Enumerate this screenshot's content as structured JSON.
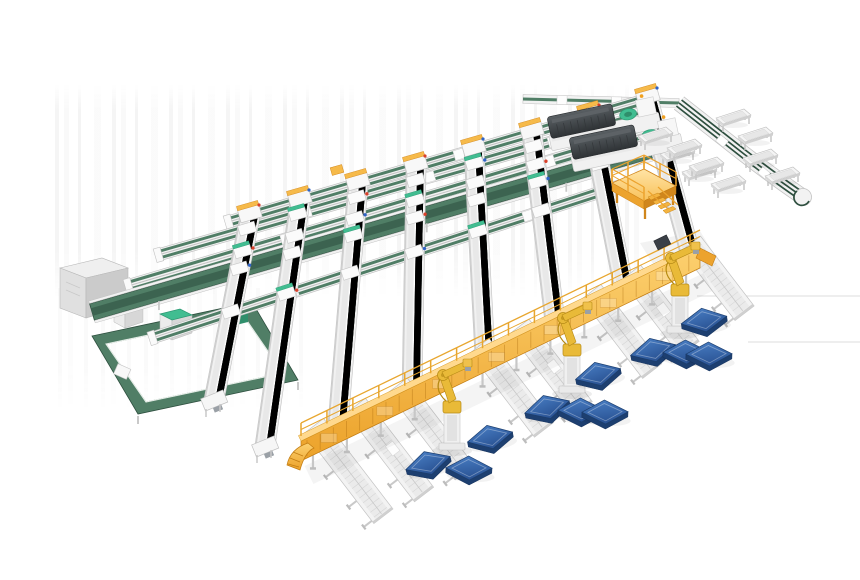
{
  "meta": {
    "description": "isometric 3d render of an automated parcel sorting and palletizing warehouse system",
    "background": "#ffffff",
    "canvas": {
      "w": 860,
      "h": 580
    }
  },
  "names": {
    "scene": "warehouse-3d-scene",
    "grid_line": "conveyor-line",
    "sorting_lane": "sorting-lane",
    "crossing_module": "transfer-module",
    "loop": "loop-conveyor",
    "cabinet": "control-cabinet",
    "small_machine": "scanner-machine",
    "dark_machine": "printer-sorter-machine",
    "platform": "operator-platform",
    "stairs": "platform-stairs",
    "outfeed": "outfeed-conveyor",
    "stand": "tray-stand",
    "walkway": "elevated-walkway-conveyor",
    "ramp": "walkway-ramp",
    "railing": "walkway-railing",
    "out_lane": "roller-lane",
    "robot": "palletizing-robot",
    "pallet": "pallet",
    "shadow": "floor-shadow",
    "floor_line": "floor-guide-line",
    "accent": "accent-marker"
  },
  "colors": {
    "frame": "#f2f2f2",
    "frame_mid": "#e4e4e4",
    "frame_dark": "#c2c2c2",
    "frame_edge": "#aeaeae",
    "belt": "#507e66",
    "belt_dark": "#3c6350",
    "belt_deep": "#2e4f3f",
    "teal": "#41bd91",
    "teal_dark": "#2d9a74",
    "teal_side": "#2f8e6b",
    "yellow_top": "#ffd98e",
    "yellow": "#f6ba4a",
    "yellow_mid": "#eca32e",
    "yellow_dark": "#d0861c",
    "yellow_deep": "#c27c12",
    "robot": "#e9ba38",
    "robot_dark": "#b68a16",
    "metal": "#eeeeee",
    "metal_dark": "#c9c9c9",
    "blue_side": "#1d3f70",
    "blue_edge": "#1c3e6e",
    "machine_edge": "#26292c",
    "machine_ridge": "#5d6266",
    "machine_vent": "#33373a",
    "red": "#d8402a",
    "dot_blue": "#2f63c6",
    "orange": "#f0a020",
    "dark_box": "#3a3f46",
    "shadow": "rgba(0,0,0,0.05)",
    "shadow_soft": "rgba(0,0,0,0.045)"
  },
  "scene": {
    "a_lines": [
      {
        "x1": 523,
        "y1": 99,
        "x2": 679,
        "y2": 103,
        "w": 9,
        "style": "perimeter"
      },
      {
        "x1": 228,
        "y1": 222,
        "x2": 648,
        "y2": 99,
        "w": 12,
        "style": "default"
      },
      {
        "x1": 158,
        "y1": 255,
        "x2": 652,
        "y2": 113,
        "w": 12,
        "style": "default"
      },
      {
        "x1": 128,
        "y1": 286,
        "x2": 655,
        "y2": 130,
        "w": 13,
        "style": "default"
      },
      {
        "x1": 92,
        "y1": 312,
        "x2": 650,
        "y2": 150,
        "w": 17,
        "style": "wide"
      },
      {
        "x1": 152,
        "y1": 338,
        "x2": 622,
        "y2": 185,
        "w": 12,
        "style": "default"
      }
    ],
    "b_lanes": [
      {
        "x1": 250,
        "y1": 216,
        "x2": 214,
        "y2": 400
      },
      {
        "x1": 300,
        "y1": 201,
        "x2": 265,
        "y2": 446
      },
      {
        "x1": 358,
        "y1": 184,
        "x2": 338,
        "y2": 424
      },
      {
        "x1": 416,
        "y1": 167,
        "x2": 412,
        "y2": 391
      },
      {
        "x1": 474,
        "y1": 150,
        "x2": 485,
        "y2": 356
      },
      {
        "x1": 532,
        "y1": 133,
        "x2": 555,
        "y2": 322
      },
      {
        "x1": 590,
        "y1": 116,
        "x2": 624,
        "y2": 289
      },
      {
        "x1": 648,
        "y1": 99,
        "x2": 691,
        "y2": 256
      }
    ],
    "lane_w": 20,
    "loop": {
      "outer": [
        [
          92,
          336
        ],
        [
          252,
          302
        ],
        [
          298,
          380
        ],
        [
          138,
          414
        ]
      ],
      "inner": [
        [
          106,
          344
        ],
        [
          243,
          315
        ],
        [
          283,
          373
        ],
        [
          146,
          402
        ]
      ],
      "green_box": [
        231,
        311
      ],
      "module": [
        122,
        372
      ]
    },
    "cabinet": {
      "top": [
        [
          60,
          268
        ],
        [
          102,
          258
        ],
        [
          128,
          268
        ],
        [
          86,
          278
        ]
      ],
      "front": [
        [
          60,
          268
        ],
        [
          86,
          278
        ],
        [
          86,
          318
        ],
        [
          60,
          308
        ]
      ],
      "side": [
        [
          86,
          278
        ],
        [
          128,
          268
        ],
        [
          128,
          306
        ],
        [
          86,
          318
        ]
      ]
    },
    "small_machines": [
      {
        "top": [
          [
            114,
            303
          ],
          [
            132,
            298
          ],
          [
            143,
            304
          ],
          [
            125,
            309
          ]
        ],
        "front": [
          [
            114,
            303
          ],
          [
            125,
            309
          ],
          [
            125,
            328
          ],
          [
            114,
            322
          ]
        ],
        "side": [
          [
            125,
            309
          ],
          [
            143,
            304
          ],
          [
            143,
            322
          ],
          [
            125,
            328
          ]
        ]
      },
      {
        "top": [
          [
            160,
            314
          ],
          [
            180,
            309
          ],
          [
            192,
            315
          ],
          [
            172,
            320
          ]
        ],
        "front": [
          [
            160,
            314
          ],
          [
            172,
            320
          ],
          [
            172,
            340
          ],
          [
            160,
            334
          ]
        ],
        "side": [
          [
            172,
            320
          ],
          [
            192,
            315
          ],
          [
            192,
            333
          ],
          [
            172,
            340
          ]
        ]
      }
    ],
    "dark_machines": [
      {
        "x": 549,
        "y": 127
      },
      {
        "x": 571,
        "y": 148
      }
    ],
    "platform": {
      "floor": [
        [
          612,
          183
        ],
        [
          644,
          169
        ],
        [
          676,
          186
        ],
        [
          644,
          201
        ]
      ],
      "face_sw": [
        [
          612,
          183
        ],
        [
          644,
          201
        ],
        [
          644,
          209
        ],
        [
          612,
          191
        ]
      ],
      "face_se": [
        [
          644,
          201
        ],
        [
          676,
          186
        ],
        [
          676,
          194
        ],
        [
          644,
          209
        ]
      ],
      "legs": [
        [
          617,
          188
        ],
        [
          645,
          204
        ],
        [
          673,
          190
        ],
        [
          640,
          174
        ]
      ],
      "stairs_from": [
        648,
        197
      ]
    },
    "outfeed_path": "M679,103 C712,129 730,143 744,154 C766,171 784,184 800,195",
    "outfeed_turn": [
      800,
      195
    ],
    "outfeed_boxes": [
      [
        722,
        141
      ],
      [
        764,
        173
      ]
    ],
    "stands": [
      [
        655,
        136
      ],
      [
        677,
        154
      ],
      [
        699,
        172
      ],
      [
        684,
        148
      ],
      [
        706,
        166
      ],
      [
        728,
        184
      ],
      [
        733,
        118
      ],
      [
        755,
        136
      ],
      [
        760,
        158
      ],
      [
        782,
        176
      ]
    ],
    "walkway": {
      "x1": 301,
      "y1": 441,
      "x2": 700,
      "y2": 248,
      "face": 20
    },
    "out_lanes": {
      "ts": [
        0.045,
        0.15,
        0.255,
        0.46,
        0.56,
        0.74,
        0.84,
        0.99
      ],
      "lens": [
        114,
        112,
        110,
        106,
        104,
        100,
        96,
        88
      ],
      "angle_deg": 52.5,
      "boxed": [
        1,
        4,
        6
      ]
    },
    "robots": [
      {
        "x": 452,
        "y": 448
      },
      {
        "x": 572,
        "y": 391
      },
      {
        "x": 680,
        "y": 331
      }
    ],
    "pallets": [
      {
        "x": 428,
        "y": 463,
        "r": -14
      },
      {
        "x": 469,
        "y": 468,
        "r": 3
      },
      {
        "x": 490,
        "y": 437,
        "r": -10
      },
      {
        "x": 547,
        "y": 407,
        "r": -13
      },
      {
        "x": 581,
        "y": 410,
        "r": 2
      },
      {
        "x": 605,
        "y": 412,
        "r": 2
      },
      {
        "x": 598,
        "y": 374,
        "r": -11
      },
      {
        "x": 653,
        "y": 350,
        "r": -11
      },
      {
        "x": 686,
        "y": 352,
        "r": 2
      },
      {
        "x": 709,
        "y": 354,
        "r": 2
      },
      {
        "x": 704,
        "y": 320,
        "r": -7
      }
    ],
    "floor_lines": [
      [
        697,
        296,
        860,
        296
      ],
      [
        748,
        342,
        860,
        342
      ]
    ],
    "shadow_wedge": [
      [
        640,
        243
      ],
      [
        700,
        231
      ],
      [
        716,
        257
      ],
      [
        656,
        269
      ]
    ],
    "walkway_box": [
      664,
      246
    ],
    "accent_yellow_box": [
      337,
      170
    ]
  }
}
